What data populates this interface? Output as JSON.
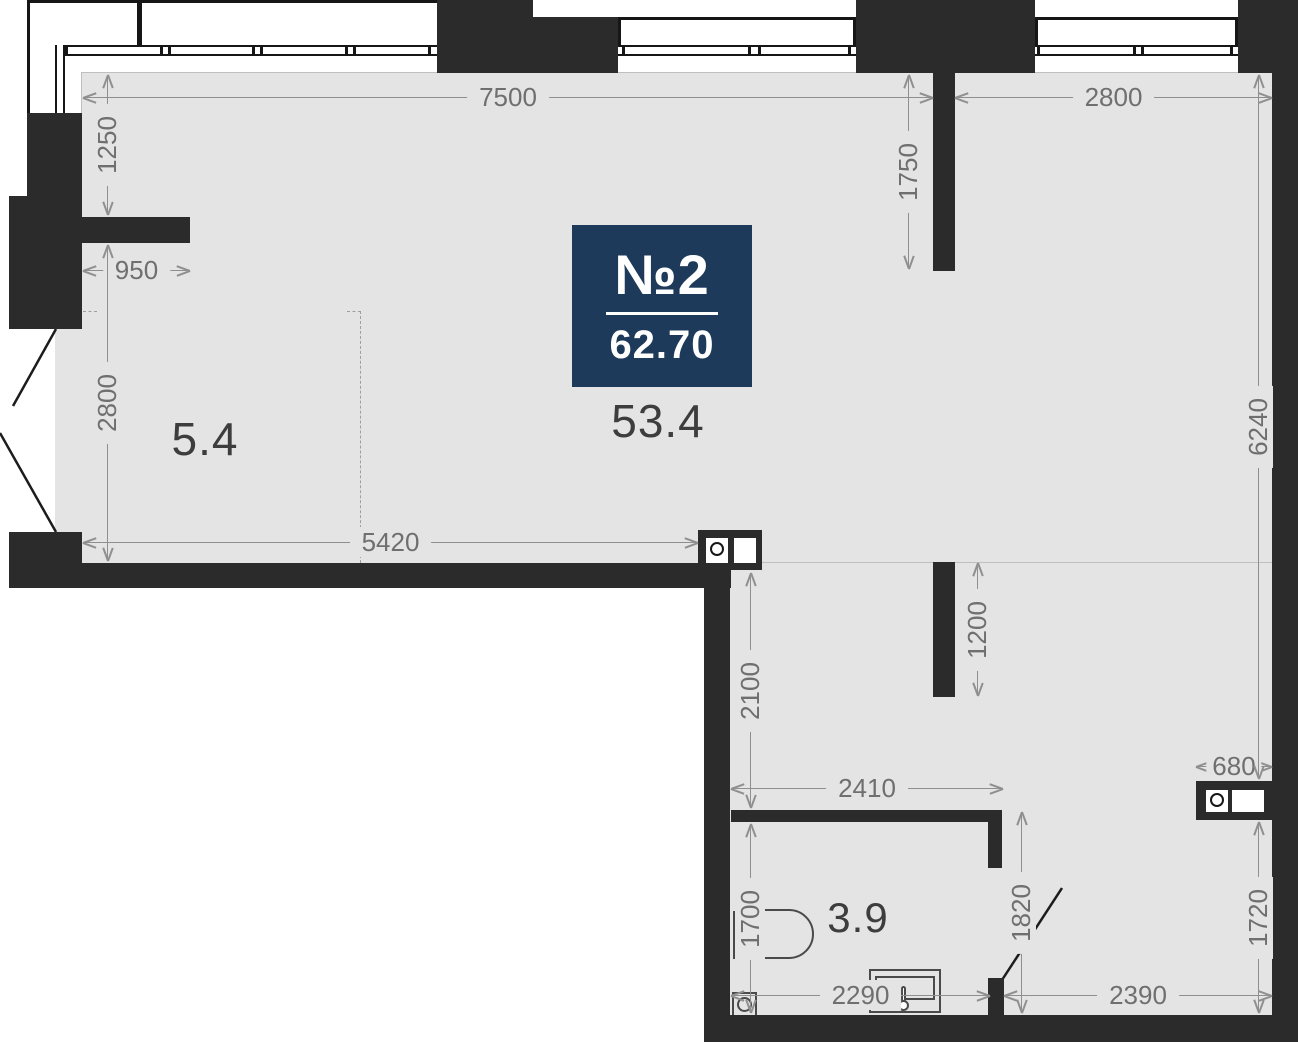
{
  "plan": {
    "badge": {
      "number": "№2",
      "area": "62.70"
    },
    "rooms": {
      "main_area": "53.4",
      "balcony_area": "5.4",
      "bathroom_area": "3.9"
    },
    "dimensions": {
      "top_width": "7500",
      "top_right_width": "2800",
      "left_upper": "1250",
      "pier_width": "950",
      "left_lower": "2800",
      "top_stub": "1750",
      "right_upper": "6240",
      "main_width": "5420",
      "hall_upper": "2100",
      "partition": "1200",
      "hall_width": "2410",
      "shaft_width": "680",
      "bath_door": "1820",
      "right_lower": "1720",
      "bath_height": "1700",
      "bath_width": "2290",
      "lower_width": "2390"
    },
    "colors": {
      "wall": "#2b2b2b",
      "floor": "#e4e4e4",
      "badge": "#1e3a5a",
      "dimension_text": "#6f6f6f",
      "room_text": "#3d3d3d"
    }
  }
}
